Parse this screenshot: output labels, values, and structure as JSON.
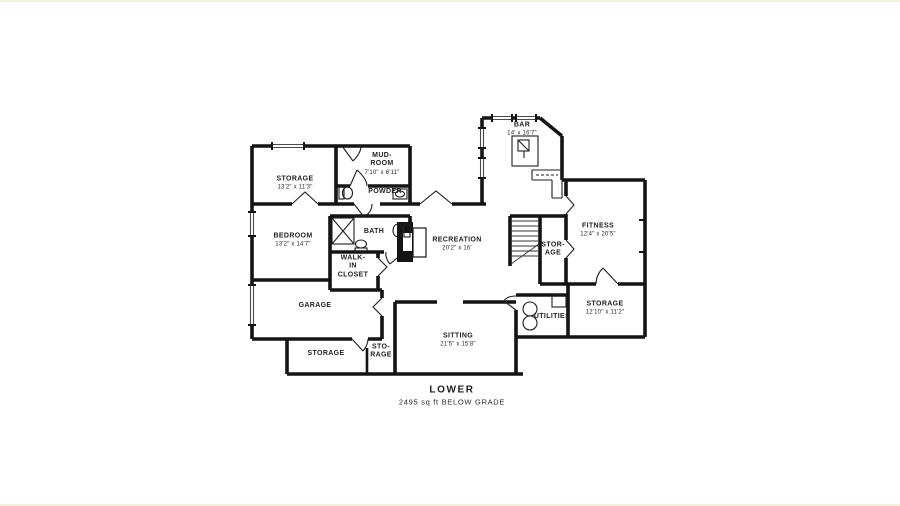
{
  "page": {
    "background": "#ffffff",
    "ink": "#141414",
    "edge_tint": "#f4efd8"
  },
  "floorplan": {
    "title": "LOWER",
    "subtitle": "2495 sq ft BELOW GRADE",
    "rooms": [
      {
        "id": "storage-nw",
        "name": "STORAGE",
        "dims": "13'2\" x 11'3\""
      },
      {
        "id": "mud-room",
        "name": "MUD-\nROOM",
        "dims": "7'10\" x 6'11\""
      },
      {
        "id": "powder",
        "name": "POWDER",
        "dims": ""
      },
      {
        "id": "bedroom",
        "name": "BEDROOM",
        "dims": "13'2\" x 14'7\""
      },
      {
        "id": "bath",
        "name": "BATH",
        "dims": ""
      },
      {
        "id": "walk-in-closet",
        "name": "WALK-\nIN\nCLOSET",
        "dims": ""
      },
      {
        "id": "garage",
        "name": "GARAGE",
        "dims": ""
      },
      {
        "id": "storage-sw",
        "name": "STORAGE",
        "dims": ""
      },
      {
        "id": "storage-small",
        "name": "STO-\nRAGE",
        "dims": ""
      },
      {
        "id": "sitting",
        "name": "SITTING",
        "dims": "21'5\" x 15'8\""
      },
      {
        "id": "recreation",
        "name": "RECREATION",
        "dims": "20'2\" x 16'"
      },
      {
        "id": "bar",
        "name": "BAR",
        "dims": "14' x 16'7\""
      },
      {
        "id": "stor-age",
        "name": "STOR-\nAGE",
        "dims": ""
      },
      {
        "id": "fitness",
        "name": "FITNESS",
        "dims": "12'4\" x 20'5\""
      },
      {
        "id": "storage-se",
        "name": "STORAGE",
        "dims": "12'10\" x 11'2\""
      },
      {
        "id": "utilities",
        "name": "UTILITIES",
        "dims": ""
      }
    ]
  }
}
